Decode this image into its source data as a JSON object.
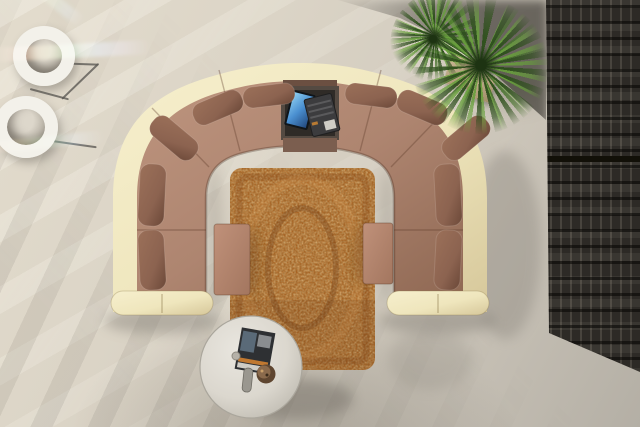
{
  "palette": {
    "floor_light": "#e3dccd",
    "floor_mid": "#d3ccbf",
    "floor_dark": "#b4afa5",
    "sofa_cream": "#efe6bd",
    "sofa_cream_dark": "#d6c79a",
    "seat_brown": "#ae8570",
    "seat_brown_dark": "#8f6853",
    "pillow_brown": "#8c6350",
    "pillow_dark": "#6b4838",
    "rug_base": "#a86120",
    "rug_light": "#d59a4e",
    "rug_dark": "#5f3410",
    "ottoman": "#b5886e",
    "table_top": "#dbd7ce",
    "panel_dark": "#2d2a26",
    "panel_frame": "#15130f",
    "plant_green": "#46722b",
    "plant_green_light": "#68a03c",
    "pot_beige": "#cdbb98",
    "lamp_white": "#f3f1ea",
    "laptop_screen": "#4a8fd0",
    "magazine_dark": "#2e3033",
    "shadow": "#6f6a62"
  },
  "scene": {
    "description": "Top-down 3D render of a living room: cream U-shaped sectional sofa with brown seats and cushions around an orange patterned rug, two brown footstools, a round white coffee table with a magazine, a laptop on the sofa console, two potted yucca plants, two cylindrical floor lamps with light flares, and a dark slatted room divider along the right edge.",
    "objects": {
      "sofa": {
        "label": "U-shaped sectional sofa",
        "body_color": "#efe6bd",
        "seat_color": "#ae8570",
        "pillow_color": "#8c6350",
        "pillow_count": 10
      },
      "console": {
        "label": "built-in sofa console with laptop",
        "laptop_screen_color": "#4a8fd0"
      },
      "rug": {
        "label": "orange patterned area rug",
        "color": "#a86120"
      },
      "ottomans": {
        "label": "brown footstools",
        "color": "#b5886e",
        "count": 2
      },
      "coffee_table": {
        "label": "round white coffee table",
        "color": "#dbd7ce",
        "items": [
          "magazine",
          "remote control",
          "bowl"
        ]
      },
      "plants": {
        "label": "potted yucca plants",
        "leaf_color": "#46722b",
        "pot_color": "#cdbb98",
        "count": 2
      },
      "lamps": {
        "label": "cylindrical floor lamps",
        "color": "#f3f1ea",
        "count": 2
      },
      "screen": {
        "label": "dark slatted room divider",
        "color": "#2d2a26"
      },
      "floor": {
        "label": "sunlit stone floor with light stripes",
        "color": "#d3ccbf"
      }
    }
  }
}
